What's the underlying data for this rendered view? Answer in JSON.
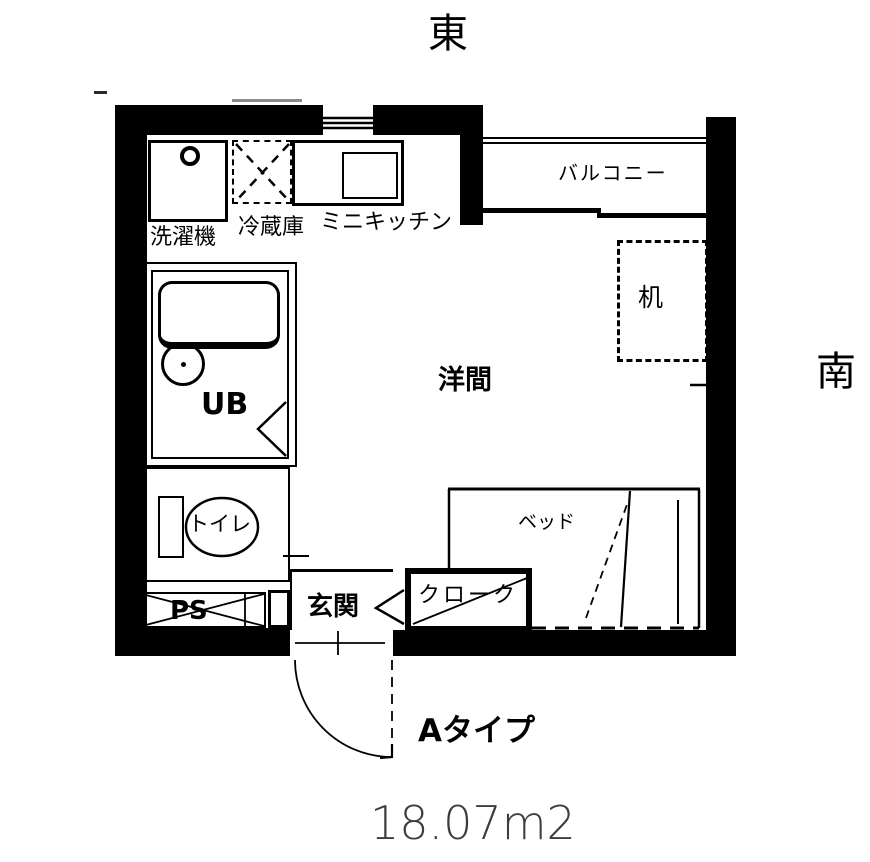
{
  "compass": {
    "east": "東",
    "south": "南"
  },
  "labels": {
    "washing_machine": "洗濯機",
    "refrigerator": "冷蔵庫",
    "mini_kitchen": "ミニキッチン",
    "balcony": "バルコニー",
    "desk": "机",
    "western_room": "洋間",
    "unit_bath": "UB",
    "toilet": "トイレ",
    "pipe_space": "PS",
    "entrance": "玄関",
    "closet": "クローク",
    "bed": "ベッド"
  },
  "footer": {
    "unit_type": "Aタイプ",
    "floor_area": "18.07m2"
  },
  "colors": {
    "line": "#000000",
    "background": "#ffffff",
    "area_text": "#3d3d3d"
  }
}
